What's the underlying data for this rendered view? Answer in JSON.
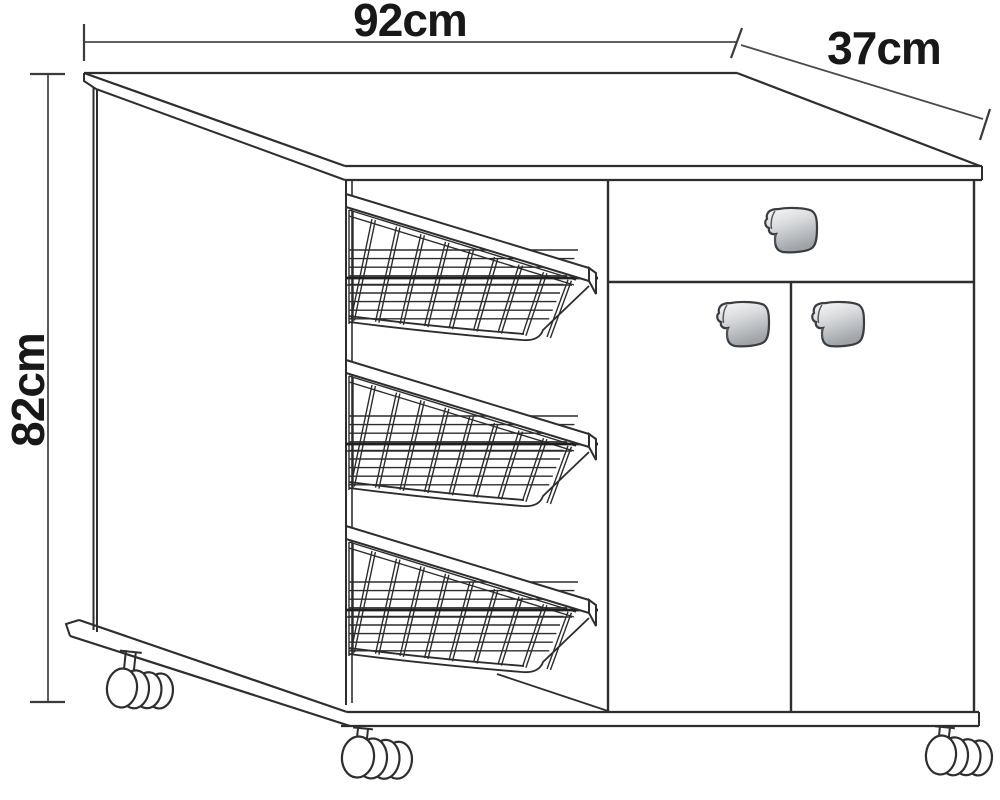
{
  "diagram": {
    "background_color": "#ffffff",
    "line_color": "#2e2e2e",
    "annotation_color": "#181818"
  },
  "dimensions": {
    "width": {
      "label": "92cm",
      "value": 92,
      "unit": "cm",
      "edge": "top"
    },
    "depth": {
      "label": "37cm",
      "value": 37,
      "unit": "cm",
      "edge": "top-right"
    },
    "height": {
      "label": "82cm",
      "value": 82,
      "unit": "cm",
      "edge": "left"
    }
  },
  "furniture": {
    "baskets_count": 3,
    "drawers_count": 1,
    "doors_count": 2,
    "handles_count": 3,
    "casters_count": 3,
    "handle_colors": {
      "light": "#fbfbfb",
      "mid": "#d7d9db",
      "dark": "#9fa4a9",
      "outline": "#3a3e42"
    }
  }
}
